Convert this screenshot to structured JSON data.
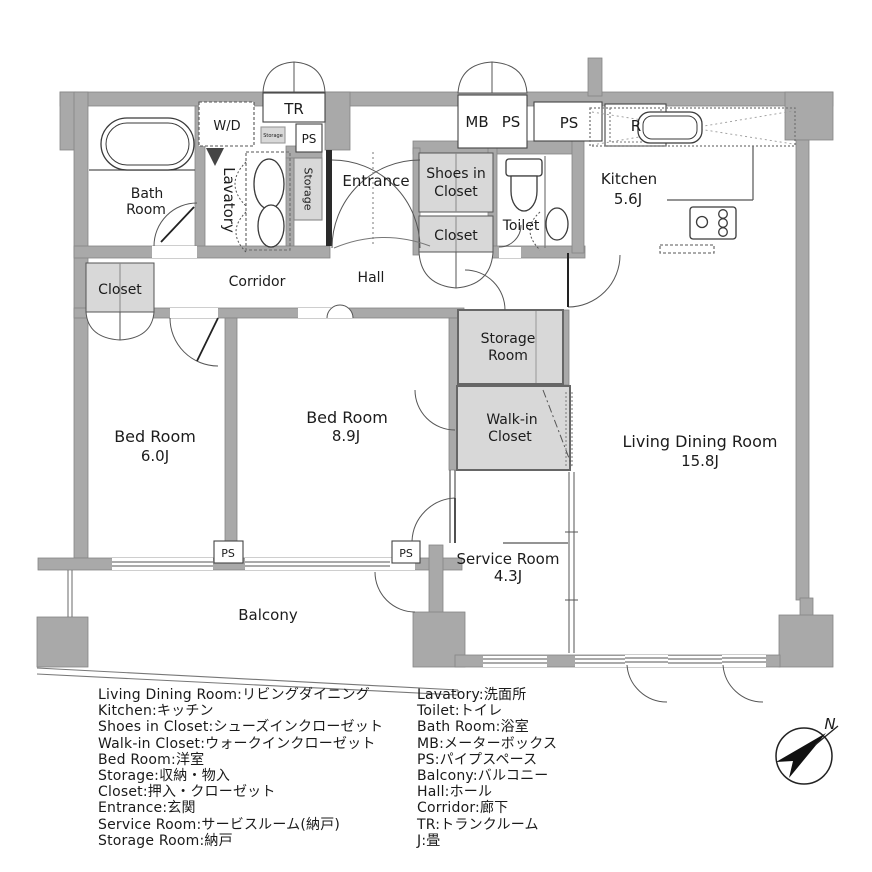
{
  "plan": {
    "labels": {
      "bath1": "Bath",
      "bath2": "Room",
      "wd": "W/D",
      "tr": "TR",
      "ps_top_small": "PS",
      "storage_mini": "Storage",
      "storage_vertical": "Storage",
      "lavatory": "Lavatory",
      "entrance": "Entrance",
      "mb": "MB",
      "ps_mb": "PS",
      "ps_top": "PS",
      "r_box": "R",
      "kitchen": "Kitchen",
      "kitchen_size": "5.6J",
      "shoes1": "Shoes in",
      "shoes2": "Closet",
      "closet_upper": "Closet",
      "toilet": "Toilet",
      "closet_left": "Closet",
      "corridor": "Corridor",
      "hall": "Hall",
      "storage_room1": "Storage",
      "storage_room2": "Room",
      "walkin1": "Walk-in",
      "walkin2": "Closet",
      "bed_a": "Bed Room",
      "bed_a_size": "6.0J",
      "bed_b": "Bed Room",
      "bed_b_size": "8.9J",
      "ldk": "Living Dining Room",
      "ldk_size": "15.8J",
      "service": "Service Room",
      "service_size": "4.3J",
      "ps_bottom1": "PS",
      "ps_bottom2": "PS",
      "balcony": "Balcony"
    },
    "compass_north": "N",
    "colors": {
      "wall": "#a9a9a9",
      "wall_edge": "#858585",
      "closet_fill": "#d8d8d8",
      "line": "#555555",
      "text": "#1c1c1c"
    }
  },
  "legend": {
    "left": [
      "Living Dining Room:リビングダイニング",
      "Kitchen:キッチン",
      "Shoes in Closet:シューズインクローゼット",
      "Walk-in Closet:ウォークインクローゼット",
      "Bed Room:洋室",
      "Storage:収納・物入",
      "Closet:押入・クローゼット",
      "Entrance:玄関",
      "Service Room:サービスルーム(納戸)",
      "Storage Room:納戸"
    ],
    "right": [
      "Lavatory:洗面所",
      "Toilet:トイレ",
      "Bath Room:浴室",
      "MB:メーターボックス",
      "PS:パイプスペース",
      "Balcony:バルコニー",
      "Hall:ホール",
      "Corridor:廊下",
      "TR:トランクルーム",
      "J:畳"
    ]
  }
}
